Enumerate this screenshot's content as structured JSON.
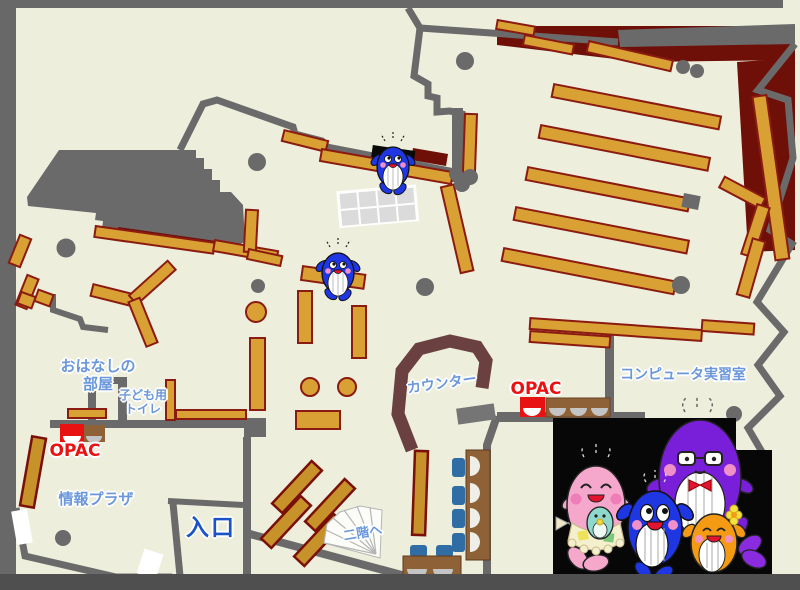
{
  "map": {
    "title": "library-first-floor-map",
    "labels": {
      "story_room": [
        "おはなしの",
        "部屋"
      ],
      "kids_toilet": [
        "子ども用",
        "トイレ"
      ],
      "opac_left": "OPAC",
      "opac_right": "OPAC",
      "info_plaza": "情報プラザ",
      "entrance": "入口",
      "counter": "カウンター",
      "computer_room": "コンピュータ実習室",
      "to_second_floor": "二階へ"
    },
    "colors": {
      "floor": "#EDEEDC",
      "wall_gray": "#6A6A6A",
      "bottom_bar": "#4F4F4F",
      "shelf": "#D9A033",
      "shelf_dark": "#C8922A",
      "shelf_border": "#8B1A10",
      "dark_red_area": "#6E0F08",
      "counter_brown": "#6B4040",
      "opac_red": "#E91212",
      "label_blue": "#6A97DC",
      "entrance_blue": "#1A52C8",
      "chair_blue": "#2F6DA4",
      "desk_brown": "#8F6136",
      "mascot_pink": "#F5A8CC",
      "mascot_blue": "#1F36E3",
      "mascot_purple": "#7A1FD9",
      "mascot_orange": "#F59B13"
    },
    "mascots": {
      "panel": [
        "pink-mother-whale",
        "blue-child-whale",
        "purple-father-whale",
        "orange-child-whale"
      ],
      "on_map": [
        "blue-whale-mascot",
        "blue-whale-mascot"
      ]
    }
  }
}
